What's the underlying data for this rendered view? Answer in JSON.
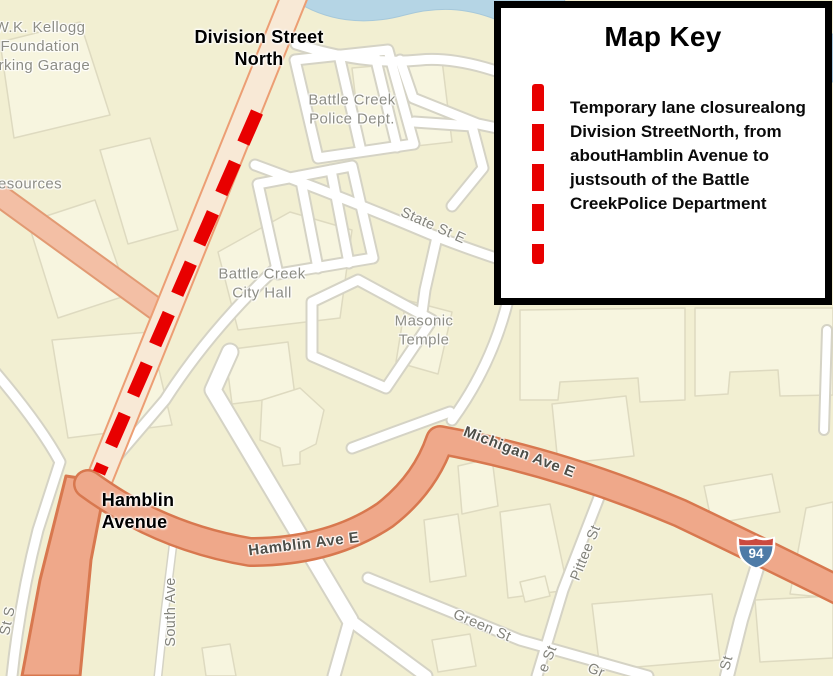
{
  "map_key": {
    "title": "Map Key",
    "legend": {
      "symbol": "red-dashed-line",
      "symbol_color": "#e80000",
      "lines": [
        "Temporary lane closure",
        "along Division Street",
        "North, from about",
        "Hamblin Avenue to just",
        "south of the Battle Creek",
        "Police Department"
      ]
    }
  },
  "annotations": {
    "division_street_north": {
      "lines": [
        "Division Street",
        "North"
      ]
    },
    "hamblin_avenue": {
      "lines": [
        "Hamblin",
        "Avenue"
      ]
    }
  },
  "places": {
    "kellogg_garage": {
      "lines": [
        "W.K. Kellogg",
        "Foundation",
        "arking Garage"
      ]
    },
    "resources_partial": {
      "text": "esources"
    },
    "police_dept": {
      "lines": [
        "Battle Creek",
        "Police Dept."
      ]
    },
    "city_hall": {
      "lines": [
        "Battle Creek",
        "City Hall"
      ]
    },
    "masonic_temple": {
      "lines": [
        "Masonic",
        "Temple"
      ]
    }
  },
  "streets": {
    "state_st_e": "State St E",
    "michigan_ave_e": "Michigan Ave E",
    "hamblin_ave_e": "Hamblin Ave E",
    "south_ave": "South Ave",
    "green_st": "Green St",
    "pittee_st": "Pittee St",
    "partial_st_s": "St S",
    "partial_e_st": "e St",
    "partial_st": "St",
    "partial_gr": "Gr"
  },
  "shield": {
    "system": "Interstate",
    "route": "94"
  },
  "colors": {
    "closure_red": "#e80000",
    "major_road_salmon": "#efa88a",
    "major_road_casing": "#d8784f",
    "division_road_fill": "#f8e9d6",
    "secondary_road_fill": "#f3bfa5",
    "minor_road_fill": "#ffffff",
    "minor_road_casing": "#d5d3c5",
    "background": "#f2efd2",
    "building_fill": "#f7f5df",
    "water": "#b5d5e5",
    "shield_blue": "#4e7ba7",
    "shield_red": "#cb4a3e"
  }
}
